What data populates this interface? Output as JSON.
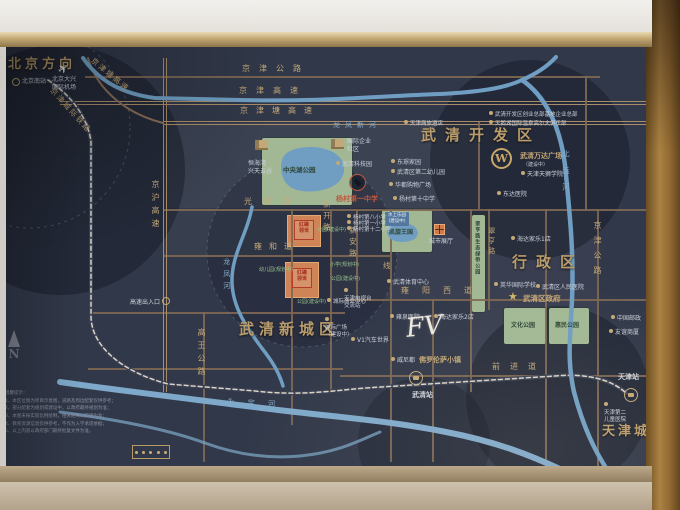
{
  "board_bg": "#313849",
  "compass": {
    "label": "N"
  },
  "legend": {
    "tick_count": 5
  },
  "disclaimer": {
    "title": "温馨提示：",
    "lines": [
      "1、本区位图为项目示意图，道路及周边配套仅供参考；",
      "2、部分配套为规划或建设中，以政府最终规划为准；",
      "3、本图未按实际比例绘制，相关距离以实测为准；",
      "4、教育资源信息仅供参考，不作为入学承诺依据；",
      "5、以上内容以政府部门最终批复文件为准。"
    ]
  },
  "map": {
    "panels": [
      {
        "x": 163,
        "y": 123,
        "w": 315,
        "h": 85,
        "o": 0.05
      },
      {
        "x": 330,
        "y": 209,
        "w": 267,
        "h": 90,
        "o": 0.04
      },
      {
        "x": 163,
        "y": 209,
        "w": 128,
        "h": 46,
        "o": 0.03
      },
      {
        "x": 470,
        "y": 299,
        "w": 127,
        "h": 76,
        "o": 0.04
      }
    ],
    "discs": [
      {
        "cx": 60,
        "cy": 170,
        "r": 125,
        "o": 0.38
      },
      {
        "cx": 530,
        "cy": 160,
        "r": 100,
        "o": 0.38
      },
      {
        "cx": 558,
        "cy": 398,
        "r": 92,
        "o": 0.38
      },
      {
        "cx": 424,
        "cy": 443,
        "r": 66,
        "o": 0.3
      },
      {
        "cx": 302,
        "cy": 252,
        "r": 95,
        "o": 0.22
      }
    ],
    "rings": [
      {
        "cx": 302,
        "cy": 252,
        "r": 95
      },
      {
        "cx": 30,
        "cy": 128,
        "r": 100
      }
    ],
    "roads_h": [
      {
        "x": 85,
        "y": 76,
        "w": 515
      },
      {
        "x": 60,
        "y": 101,
        "w": 586,
        "hw": 1
      },
      {
        "x": 163,
        "y": 121,
        "w": 483,
        "hw": 1
      },
      {
        "x": 163,
        "y": 209,
        "w": 483
      },
      {
        "x": 163,
        "y": 255,
        "w": 227
      },
      {
        "x": 345,
        "y": 299,
        "w": 301
      },
      {
        "x": 90,
        "y": 312,
        "w": 255
      },
      {
        "x": 88,
        "y": 368,
        "w": 255
      },
      {
        "x": 340,
        "y": 375,
        "w": 306
      }
    ],
    "roads_v": [
      {
        "x": 163,
        "y": 58,
        "h": 334,
        "hw": 1
      },
      {
        "x": 203,
        "y": 312,
        "h": 150
      },
      {
        "x": 291,
        "y": 209,
        "h": 216
      },
      {
        "x": 330,
        "y": 209,
        "h": 183
      },
      {
        "x": 356,
        "y": 209,
        "h": 91
      },
      {
        "x": 390,
        "y": 209,
        "h": 253
      },
      {
        "x": 432,
        "y": 299,
        "h": 163
      },
      {
        "x": 478,
        "y": 122,
        "h": 87
      },
      {
        "x": 470,
        "y": 209,
        "h": 183
      },
      {
        "x": 488,
        "y": 209,
        "h": 101
      },
      {
        "x": 545,
        "y": 209,
        "h": 259
      },
      {
        "x": 585,
        "y": 76,
        "h": 134
      },
      {
        "x": 597,
        "y": 209,
        "h": 259
      }
    ],
    "paths": [
      {
        "d": "M88,58 C98,92 128,114 163,123",
        "s": "#8a6f58",
        "w": 2
      },
      {
        "d": "M48,80 C72,96 88,118 91,142 L91,316 C91,346 122,372 168,384 L255,391 C300,396 330,391 365,388 L555,376 C588,373 612,380 626,393",
        "s": "#3a4052",
        "w": 4
      },
      {
        "d": "M48,80 C72,96 88,118 91,142 L91,316 C91,346 122,372 168,384 L255,391 C300,396 330,391 365,388 L555,376 C588,373 612,380 626,393",
        "s": "#d8d3c6",
        "w": 1.5,
        "dash": "4,3"
      },
      {
        "d": "M83,58 C98,80 122,94 155,98 L240,100 C320,102 380,96 440,94 C480,92 505,88 522,80 C538,73 548,66 556,57",
        "s": "#6f9ec2",
        "w": 4
      },
      {
        "d": "M522,80 C545,96 560,125 565,165 C570,215 574,255 572,300 C570,340 567,360 574,392 C584,430 596,452 606,468",
        "s": "#6f9ec2",
        "w": 4.5
      },
      {
        "d": "M252,207 C247,235 231,255 232,283 C233,308 247,328 261,347 C272,361 279,372 283,386",
        "s": "#6f9ec2",
        "w": 3.5
      },
      {
        "d": "M60,382 C130,392 200,400 262,408 C332,417 386,420 446,432 C498,442 532,456 562,470",
        "s": "#7fa9ca",
        "w": 6
      },
      {
        "d": "M60,412 C120,420 170,430 205,443 C235,454 268,459 300,456 C340,452 360,440 380,432",
        "s": "#7fa9ca",
        "w": 3,
        "o": 0.7
      },
      {
        "d": "M288,152 C300,145 324,145 336,154 C348,163 346,177 335,185 C322,193 299,194 289,186 C279,178 278,158 288,152",
        "s": "none",
        "w": 0,
        "f": "#6f9ec2"
      },
      {
        "d": "M390,226 C396,222 410,222 415,227 C420,232 418,239 410,241 C402,243 392,242 389,237 C386,233 386,229 390,226",
        "s": "none",
        "w": 0,
        "f": "#6f9ec2"
      }
    ],
    "parks": [
      {
        "x": 262,
        "y": 138,
        "w": 90,
        "h": 67
      },
      {
        "x": 382,
        "y": 210,
        "w": 50,
        "h": 42
      },
      {
        "x": 472,
        "y": 215,
        "w": 13,
        "h": 97
      },
      {
        "x": 504,
        "y": 308,
        "w": 42,
        "h": 36
      },
      {
        "x": 549,
        "y": 308,
        "w": 40,
        "h": 36
      }
    ],
    "orange_blocks": [
      {
        "x": 287,
        "y": 215,
        "w": 32,
        "h": 30
      },
      {
        "x": 285,
        "y": 262,
        "w": 32,
        "h": 34
      }
    ],
    "project_logos": [
      {
        "x": 294,
        "y": 220,
        "w": 16,
        "h": 16,
        "lines": [
          "红磡",
          "领世"
        ]
      },
      {
        "x": 292,
        "y": 268,
        "w": 16,
        "h": 16,
        "lines": [
          "红磡",
          "领世"
        ]
      }
    ],
    "blue_tags": [
      {
        "x": 385,
        "y": 212,
        "lines": [
          "水上乐园",
          "(建设中)"
        ]
      }
    ],
    "labels": [
      {
        "n": "region-beijing-direction",
        "t": "北京方向",
        "x": 8,
        "y": 57,
        "fs": 13,
        "ls": 4,
        "c": "big"
      },
      {
        "n": "region-wuqing-dev-zone",
        "t": "武清开发区",
        "x": 421,
        "y": 126,
        "fs": 15,
        "ls": 9,
        "c": "big"
      },
      {
        "n": "region-admin-district",
        "t": "行政区",
        "x": 512,
        "y": 253,
        "fs": 15,
        "ls": 9,
        "c": "big"
      },
      {
        "n": "region-wuqing-new-town",
        "t": "武清新城区",
        "x": 239,
        "y": 320,
        "fs": 15,
        "ls": 5,
        "c": "big"
      },
      {
        "n": "region-tianjin-city",
        "t": "天津城区",
        "x": 602,
        "y": 424,
        "fs": 13,
        "ls": 3,
        "c": "big"
      },
      {
        "t": "京津公路",
        "x": 242,
        "y": 64,
        "fs": 8,
        "ls": 9,
        "c": "gold"
      },
      {
        "t": "京津高速",
        "x": 239,
        "y": 86,
        "fs": 8,
        "ls": 9,
        "c": "gold"
      },
      {
        "t": "京津塘高速",
        "x": 240,
        "y": 106,
        "fs": 8,
        "ls": 8,
        "c": "gold"
      },
      {
        "t": "光明道",
        "x": 244,
        "y": 197,
        "fs": 8,
        "ls": 11,
        "c": "gold"
      },
      {
        "t": "雍和道",
        "x": 254,
        "y": 242,
        "fs": 8,
        "ls": 7,
        "c": "gold"
      },
      {
        "t": "雍阳西道",
        "x": 401,
        "y": 286,
        "fs": 8,
        "ls": 13,
        "c": "gold"
      },
      {
        "t": "前进道",
        "x": 492,
        "y": 362,
        "fs": 8,
        "ls": 10,
        "c": "gold"
      },
      {
        "t": "京沪高速",
        "x": 150,
        "y": 180,
        "fs": 8,
        "ls": 5,
        "c": "gold",
        "v": 1
      },
      {
        "t": "高王公路",
        "x": 196,
        "y": 328,
        "fs": 8,
        "ls": 5,
        "c": "gold",
        "v": 1
      },
      {
        "t": "新开路",
        "x": 322,
        "y": 200,
        "fs": 7.5,
        "ls": 4,
        "c": "gold",
        "v": 1
      },
      {
        "t": "新安路",
        "x": 348,
        "y": 226,
        "fs": 7.5,
        "ls": 4,
        "c": "gold",
        "v": 1
      },
      {
        "t": "翠亨路",
        "x": 487,
        "y": 227,
        "fs": 7,
        "ls": 3,
        "c": "gold",
        "v": 1
      },
      {
        "t": "京津公路",
        "x": 592,
        "y": 221,
        "fs": 8,
        "ls": 7,
        "c": "gold",
        "v": 1
      },
      {
        "t": "线",
        "x": 383,
        "y": 261,
        "fs": 7.5,
        "c": "gold"
      },
      {
        "t": "京津塘高速",
        "x": 95,
        "y": 56,
        "fs": 7.5,
        "ls": 2,
        "c": "gold",
        "r": 40
      },
      {
        "t": "京津城际铁路",
        "x": 55,
        "y": 86,
        "fs": 7.5,
        "ls": 2,
        "c": "gold",
        "r": 48
      },
      {
        "t": "龙凤新河",
        "x": 333,
        "y": 121,
        "fs": 7,
        "ls": 5,
        "c": "blue"
      },
      {
        "t": "北运河",
        "x": 561,
        "y": 150,
        "fs": 7.5,
        "ls": 9,
        "c": "blue",
        "v": 1
      },
      {
        "t": "龙凤河",
        "x": 222,
        "y": 258,
        "fs": 7,
        "ls": 5,
        "c": "blue",
        "v": 1
      },
      {
        "t": "永定河",
        "x": 227,
        "y": 397,
        "fs": 7.5,
        "ls": 13,
        "c": "blue",
        "r": 3
      },
      {
        "t": "中央湖公园",
        "x": 283,
        "y": 166,
        "fs": 6.5,
        "c": "dark"
      },
      {
        "t": "凯旋王国",
        "x": 389,
        "y": 229,
        "fs": 6,
        "c": "dark"
      },
      {
        "t": "文化公园",
        "x": 511,
        "y": 322,
        "fs": 6,
        "c": "dark"
      },
      {
        "t": "惠民公园",
        "x": 555,
        "y": 322,
        "fs": 6,
        "c": "dark"
      },
      {
        "t": "翠亨路生态绿带公园",
        "x": 474,
        "y": 221,
        "fs": 5,
        "ls": 1,
        "c": "dark",
        "v": 1
      },
      {
        "t": "天津商旅酒店",
        "x": 404,
        "y": 120,
        "fs": 5.5,
        "c": "white",
        "i": 1
      },
      {
        "t": "武清开发区创业总部基地企业总部",
        "x": 489,
        "y": 111,
        "fs": 5.5,
        "c": "white",
        "i": 1
      },
      {
        "t": "天鹅湖国际温泉高尔夫俱乐部",
        "x": 489,
        "y": 120,
        "fs": 5.5,
        "c": "white",
        "i": 1
      },
      {
        "t": "东璟家园",
        "x": 391,
        "y": 159,
        "fs": 6,
        "c": "white",
        "i": 1
      },
      {
        "t": "武清区第二幼儿园",
        "x": 391,
        "y": 169,
        "fs": 6,
        "c": "white",
        "i": 1
      },
      {
        "t": "华都购物广场",
        "x": 389,
        "y": 182,
        "fs": 6,
        "c": "white",
        "i": 1
      },
      {
        "t": "杨村第十中学",
        "x": 393,
        "y": 196,
        "fs": 6,
        "c": "white",
        "i": 1
      },
      {
        "t": "武清科技园",
        "x": 336,
        "y": 161,
        "fs": 6,
        "c": "white",
        "i": 1
      },
      {
        "t": "东达医院",
        "x": 497,
        "y": 191,
        "fs": 6,
        "c": "white",
        "i": 1
      },
      {
        "t": "海达家乐1店",
        "x": 511,
        "y": 236,
        "fs": 6,
        "c": "white",
        "i": 1
      },
      {
        "t": "英华国际学校",
        "x": 494,
        "y": 282,
        "fs": 6,
        "c": "white",
        "i": 1
      },
      {
        "t": "武清区人民医院",
        "x": 536,
        "y": 284,
        "fs": 6,
        "c": "white",
        "i": 1
      },
      {
        "t": "海达家乐2店",
        "x": 434,
        "y": 314,
        "fs": 6,
        "c": "white",
        "i": 1
      },
      {
        "t": "雍泉医院",
        "x": 390,
        "y": 314,
        "fs": 6,
        "c": "white",
        "i": 1
      },
      {
        "t": "武清体育中心",
        "x": 387,
        "y": 279,
        "fs": 6,
        "c": "white",
        "i": 1
      },
      {
        "t": "中国邮政",
        "x": 611,
        "y": 315,
        "fs": 6,
        "c": "white",
        "i": 1
      },
      {
        "t": "友谊商厦",
        "x": 609,
        "y": 329,
        "fs": 6,
        "c": "white",
        "i": 1
      },
      {
        "t": "威尼都",
        "x": 391,
        "y": 357,
        "fs": 6,
        "c": "white",
        "i": 1
      },
      {
        "t": "城市展厅",
        "x": 429,
        "y": 238,
        "fs": 6,
        "c": "white"
      },
      {
        "t": "V1汽车世界",
        "x": 351,
        "y": 337,
        "fs": 6,
        "c": "white",
        "i": 1
      },
      {
        "t": "高速出入口",
        "x": 130,
        "y": 299,
        "fs": 6,
        "c": "white"
      },
      {
        "t": "城际商业中心",
        "x": 327,
        "y": 298,
        "fs": 5.5,
        "c": "white",
        "i": 1
      },
      {
        "t": "天津天狮学院",
        "x": 521,
        "y": 171,
        "fs": 6,
        "c": "white",
        "i": 1
      },
      {
        "t": "北京南站",
        "x": 22,
        "y": 78,
        "fs": 6,
        "c": "white"
      },
      {
        "lines": [
          "国际企业",
          "社区"
        ],
        "x": 347,
        "y": 138,
        "fs": 6,
        "c": "white"
      },
      {
        "lines": [
          "恒海湾",
          "兴天云谷"
        ],
        "x": 248,
        "y": 160,
        "fs": 6,
        "c": "white"
      },
      {
        "lines": [
          "天津电视台",
          "交流站"
        ],
        "x": 344,
        "y": 288,
        "fs": 5.5,
        "c": "white",
        "i": 1
      },
      {
        "lines": [
          "城际广场",
          "（建设中）"
        ],
        "x": 325,
        "y": 317,
        "fs": 5.5,
        "c": "white",
        "i": 1
      },
      {
        "lines": [
          "天津第二",
          "儿童医院"
        ],
        "x": 604,
        "y": 402,
        "fs": 5.5,
        "c": "white",
        "i": 1
      },
      {
        "lines": [
          "北京大兴",
          "国际机场"
        ],
        "x": 52,
        "y": 76,
        "fs": 6,
        "c": "white"
      },
      {
        "t": "杨村第八小学",
        "x": 347,
        "y": 214,
        "fs": 5.5,
        "c": "white",
        "i": 1
      },
      {
        "t": "杨村第一小学",
        "x": 347,
        "y": 220,
        "fs": 5.5,
        "c": "white",
        "i": 1
      },
      {
        "t": "杨村第十二小学",
        "x": 347,
        "y": 226,
        "fs": 5.5,
        "c": "white",
        "i": 1
      },
      {
        "n": "label-yangcun-no1-middle-school",
        "t": "杨村第一中学",
        "x": 336,
        "y": 195,
        "fs": 7,
        "c": "red"
      },
      {
        "t": "公园(建设中)",
        "x": 317,
        "y": 227,
        "fs": 5,
        "c": "green"
      },
      {
        "t": "幼儿园(规划中)",
        "x": 259,
        "y": 267,
        "fs": 5,
        "c": "green"
      },
      {
        "t": "小学(规划中)",
        "x": 330,
        "y": 262,
        "fs": 5,
        "c": "green"
      },
      {
        "t": "公园(建设中)",
        "x": 331,
        "y": 276,
        "fs": 5,
        "c": "green"
      },
      {
        "t": "公园(建设中)",
        "x": 297,
        "y": 299,
        "fs": 5,
        "c": "green"
      },
      {
        "n": "label-florentia-village",
        "t": "佛罗伦萨小镇",
        "x": 419,
        "y": 356,
        "fs": 7,
        "c": "gold",
        "b": 1
      },
      {
        "n": "label-wanda-plaza",
        "t": "武清万达广场",
        "x": 520,
        "y": 152,
        "fs": 7,
        "c": "gold",
        "b": 1
      },
      {
        "t": "（建设中）",
        "x": 523,
        "y": 162,
        "fs": 5,
        "c": "white"
      },
      {
        "n": "label-wuqing-station",
        "t": "武清站",
        "x": 412,
        "y": 391,
        "fs": 7,
        "c": "white",
        "b": 1
      },
      {
        "n": "label-tianjin-station",
        "t": "天津站",
        "x": 618,
        "y": 373,
        "fs": 7,
        "c": "white",
        "b": 1
      },
      {
        "n": "label-wuqing-government",
        "t": "武清区政府",
        "x": 523,
        "y": 294,
        "fs": 7.5,
        "c": "gold",
        "b": 1
      }
    ],
    "icons": [
      {
        "type": "plane",
        "x": 58,
        "y": 62,
        "s": 12,
        "n": "airport-plane-icon"
      },
      {
        "type": "ring",
        "x": 12,
        "y": 78,
        "s": 8,
        "n": "beijing-south-station-icon"
      },
      {
        "type": "bld",
        "x": 331,
        "y": 139,
        "n": "enterprise-community-building-icon"
      },
      {
        "type": "bld",
        "x": 255,
        "y": 140,
        "n": "tianyungu-building-icon"
      },
      {
        "type": "cap",
        "x": 349,
        "y": 174,
        "s": 17,
        "n": "school-graduation-cap-icon"
      },
      {
        "type": "star",
        "x": 508,
        "y": 290,
        "s": 11,
        "n": "government-star-icon"
      },
      {
        "type": "wanda",
        "x": 491,
        "y": 148,
        "s": 21,
        "n": "wanda-logo-icon"
      },
      {
        "type": "station",
        "x": 409,
        "y": 371,
        "s": 14,
        "n": "wuqing-rail-station-icon"
      },
      {
        "type": "station",
        "x": 624,
        "y": 388,
        "s": 14,
        "n": "tianjin-rail-station-icon"
      },
      {
        "type": "cross",
        "x": 434,
        "y": 224,
        "n": "city-exhibition-hall-icon"
      },
      {
        "type": "ring",
        "x": 162,
        "y": 297,
        "s": 8,
        "n": "highway-exit-icon"
      }
    ],
    "fv": {
      "t": "FV",
      "x": 406,
      "y": 312,
      "fs": 26
    }
  }
}
